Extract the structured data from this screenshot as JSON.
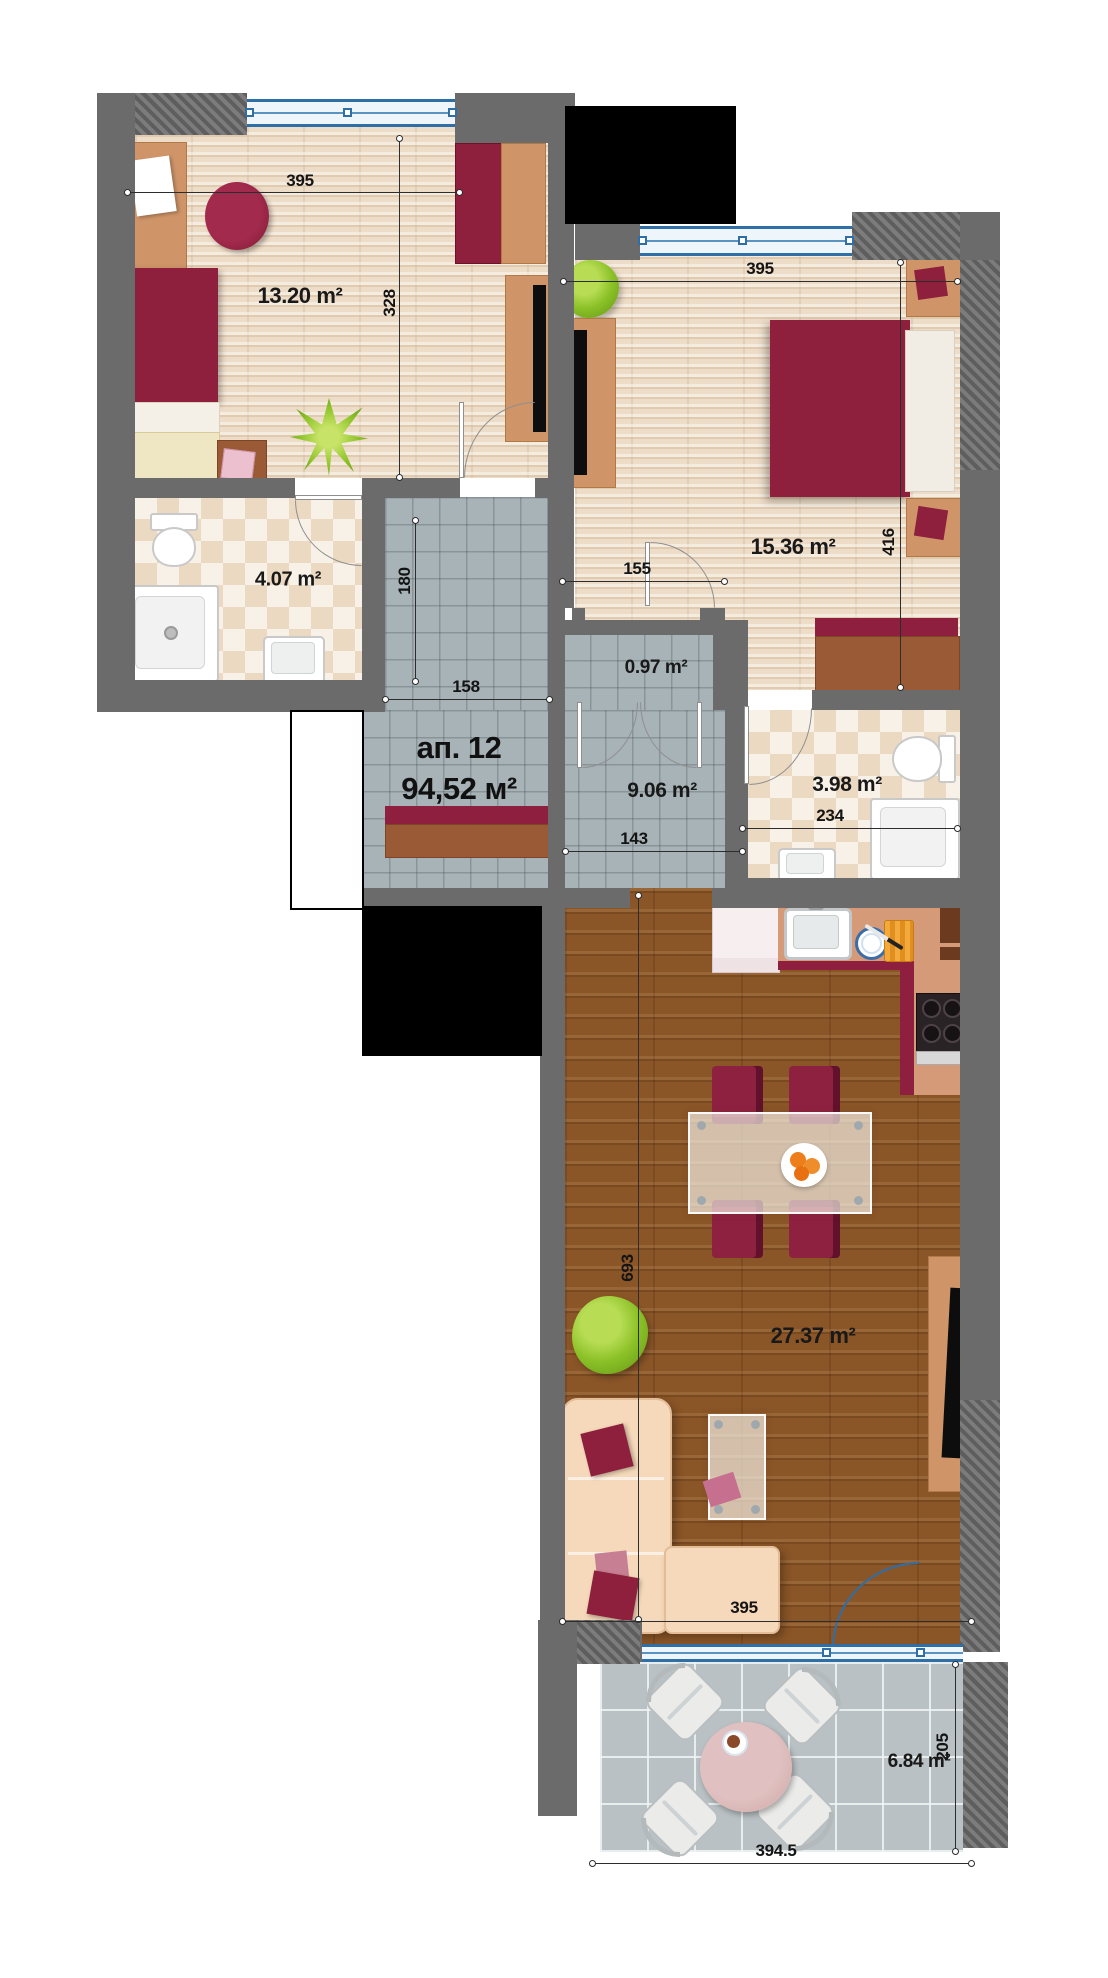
{
  "plan_title": "Apartment floor plan",
  "apartment": {
    "name": "ап. 12",
    "total_area": "94,52 м²"
  },
  "rooms": [
    {
      "id": "bedroom-1",
      "area_label": "13.20 m²"
    },
    {
      "id": "bathroom-1",
      "area_label": "4.07 m²"
    },
    {
      "id": "bedroom-2",
      "area_label": "15.36 m²"
    },
    {
      "id": "closet",
      "area_label": "0.97 m²"
    },
    {
      "id": "hallway",
      "area_label": "9.06 m²"
    },
    {
      "id": "bathroom-2",
      "area_label": "3.98 m²"
    },
    {
      "id": "living-kitchen",
      "area_label": "27.37 m²"
    },
    {
      "id": "terrace",
      "area_label": "6.84 m²"
    }
  ],
  "dimensions": [
    {
      "id": "bedroom-1-width",
      "value": "395"
    },
    {
      "id": "bedroom-1-depth",
      "value": "328"
    },
    {
      "id": "bedroom-2-width",
      "value": "395"
    },
    {
      "id": "bedroom-2-depth",
      "value": "416"
    },
    {
      "id": "bedroom-2-door",
      "value": "155"
    },
    {
      "id": "corridor-width",
      "value": "180"
    },
    {
      "id": "corridor-length",
      "value": "158"
    },
    {
      "id": "hallway-width",
      "value": "143"
    },
    {
      "id": "bathroom-2-width",
      "value": "234"
    },
    {
      "id": "living-depth",
      "value": "693"
    },
    {
      "id": "living-width",
      "value": "395"
    },
    {
      "id": "terrace-width",
      "value": "394.5"
    },
    {
      "id": "terrace-depth",
      "value": "205"
    }
  ],
  "colors": {
    "wall": "#6b6b6b",
    "accent_red": "#8e1f3d",
    "furniture_tan": "#cf9468",
    "window_blue": "#2f6fa8",
    "corridor_tile": "#a8b3b7",
    "living_wood": "#8a5527",
    "bedroom_parquet": "#eddcc7",
    "terrace_tile": "#b9c1c4"
  }
}
